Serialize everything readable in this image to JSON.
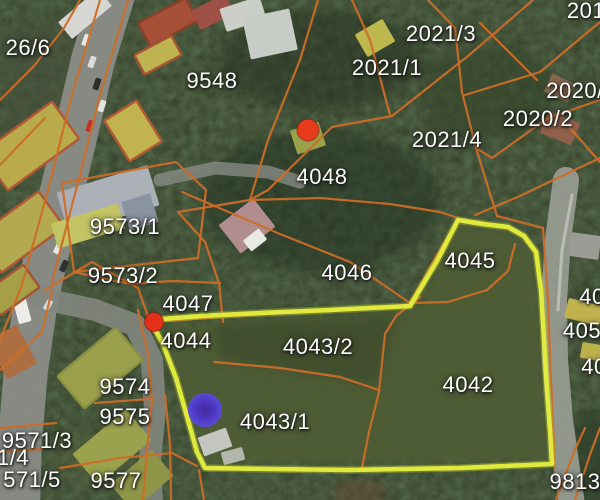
{
  "map": {
    "description": "cadastral parcel overlay on satellite imagery",
    "colors": {
      "forest_base": "#39462e",
      "foliage_dark": "#1a2914",
      "parcel_line": "#cc6d28",
      "highlight_outline": "#e6ef3e",
      "highlight_glow": "#b8c42c",
      "road_gray": "#8a8d87",
      "road_light": "#9b9e96",
      "label_text": "#fdfdfa",
      "marker_red": "#e6381d",
      "marker_purple_edge": "#5a49e0",
      "marker_purple_center": "#43279f"
    },
    "labels": [
      {
        "text": "26/6",
        "x": 28,
        "y": 48
      },
      {
        "text": "9548",
        "x": 212,
        "y": 81
      },
      {
        "text": "2021/3",
        "x": 441,
        "y": 34
      },
      {
        "text": "2021/1",
        "x": 387,
        "y": 68
      },
      {
        "text": "201",
        "x": 586,
        "y": 11
      },
      {
        "text": "2020/",
        "x": 575,
        "y": 91
      },
      {
        "text": "2020/2",
        "x": 538,
        "y": 119
      },
      {
        "text": "2021/4",
        "x": 447,
        "y": 140
      },
      {
        "text": "4048",
        "x": 322,
        "y": 177
      },
      {
        "text": "9573/1",
        "x": 125,
        "y": 227
      },
      {
        "text": "9573/2",
        "x": 123,
        "y": 276
      },
      {
        "text": "4047",
        "x": 188,
        "y": 304
      },
      {
        "text": "4044",
        "x": 186,
        "y": 341
      },
      {
        "text": "4046",
        "x": 347,
        "y": 273
      },
      {
        "text": "4045",
        "x": 470,
        "y": 261
      },
      {
        "text": "40",
        "x": 592,
        "y": 297
      },
      {
        "text": "405",
        "x": 582,
        "y": 331
      },
      {
        "text": "40",
        "x": 594,
        "y": 367
      },
      {
        "text": "4043/2",
        "x": 318,
        "y": 347
      },
      {
        "text": "4042",
        "x": 468,
        "y": 385
      },
      {
        "text": "4043/1",
        "x": 275,
        "y": 422
      },
      {
        "text": "9574",
        "x": 125,
        "y": 387
      },
      {
        "text": "9575",
        "x": 125,
        "y": 417
      },
      {
        "text": "9571/3",
        "x": 37,
        "y": 441
      },
      {
        "text": "1/4",
        "x": 13,
        "y": 458
      },
      {
        "text": "571/5",
        "x": 32,
        "y": 480
      },
      {
        "text": "9577",
        "x": 116,
        "y": 481
      },
      {
        "text": "9813",
        "x": 575,
        "y": 482
      }
    ],
    "markers": [
      {
        "name": "red-dot-marker",
        "kind": "red",
        "x": 308,
        "y": 130,
        "r": 11,
        "fill": "#e83a1d"
      },
      {
        "name": "red-pin-marker",
        "kind": "red",
        "x": 154,
        "y": 322,
        "r": 9.5,
        "fill": "#e5301c"
      },
      {
        "name": "purple-dot-marker",
        "kind": "purple",
        "x": 205,
        "y": 410,
        "r": 17
      }
    ],
    "highlight": {
      "name": "highlighted-parcel-outline",
      "points": "150,320 200,316 260,313 330,310 410,306 437,261 458,220 483,224 508,227 524,236 536,252 541,290 544,340 547,390 550,430 552,464 460,468 350,470 270,469 205,468 197,452 188,420 176,378 163,344"
    },
    "parcel_lines": [
      "100,0 72,95 48,190 22,285 0,340",
      "128,0 100,95 76,190 52,282",
      "0,100 34,66 64,28 80,0",
      "0,165 45,118",
      "318,0 300,60 268,140 250,200",
      "533,0 468,56 392,116 332,127 268,190 250,200",
      "428,0 455,28 462,92 476,148 492,200 497,216",
      "352,0 370,40 390,115",
      "600,22 540,72 465,95",
      "600,100 548,118 492,158 476,148",
      "480,23 537,80",
      "570,128 600,162",
      "475,215 520,196 562,176 600,158",
      "178,212 250,200 320,198 390,204 440,212 458,218",
      "182,192 280,234 350,262 410,303",
      "410,303 434,260 458,220",
      "62,183 176,162 206,190 198,258 74,272 62,183",
      "74,272 130,284 172,281 220,283",
      "219,283 223,322",
      "178,212 205,242 219,283",
      "150,322 220,317 300,312 412,306",
      "412,303 448,302 487,290 508,271 515,244",
      "420,297 396,316 385,334 379,392 369,432 362,468",
      "214,362 280,368 340,377 379,390",
      "543,228 548,300 551,380 555,468",
      "497,216 520,222 543,228",
      "575,500 591,452 600,428",
      "556,500 574,452 585,428",
      "45,290 92,262 138,288 150,322",
      "0,370 42,332 52,290",
      "138,310 148,355 152,400 147,450 143,500",
      "95,403 150,399",
      "60,468 120,458 172,453 197,466",
      "0,428 56,423",
      "0,452 42,449",
      "165,395 170,445 171,500",
      "199,470 204,500"
    ],
    "roads": [
      {
        "d": "M113,-5 L93,60 L72,150 L50,240 L36,300 L26,370 L20,440 L18,505",
        "width": 44,
        "color": "#8a8d87",
        "opacity": 0.95
      },
      {
        "d": "M40,298 L95,310 L135,325 L152,360 L155,410 L150,460 L152,505",
        "width": 22,
        "color": "#83867e",
        "opacity": 0.9
      },
      {
        "d": "M566,180 L558,240 L554,300 L555,360 L560,420 L572,505",
        "width": 26,
        "color": "#9b9e96",
        "opacity": 0.9
      },
      {
        "d": "M572,195 L562,250 L558,310",
        "width": 3,
        "color": "#e8eae4",
        "opacity": 0.45
      },
      {
        "d": "M160,180 L215,168 L268,172 L300,182",
        "width": 13,
        "color": "#888b84",
        "opacity": 0.8
      }
    ],
    "fields": [
      {
        "type": "polygon",
        "points": "415,310 455,225 505,228 535,252 542,330 548,430 550,462 210,464 195,430 178,380 160,325",
        "fill": "#4f5d35",
        "opacity": 0.9
      },
      {
        "type": "polygon",
        "points": "420,60 520,40 560,90 520,140 430,130",
        "fill": "#36452c",
        "opacity": 0.6
      },
      {
        "type": "polygon",
        "points": "0,30 80,10 120,60 60,140 0,150",
        "fill": "#46503a",
        "opacity": 0.55
      },
      {
        "type": "polygon",
        "points": "215,325 400,315 375,385 220,360",
        "fill": "#3c4a2c",
        "opacity": 0.7
      },
      {
        "type": "ellipse",
        "cx": 320,
        "cy": 200,
        "rx": 120,
        "ry": 70,
        "fill": "#243220",
        "opacity": 0.5
      },
      {
        "type": "ellipse",
        "cx": 320,
        "cy": 60,
        "rx": 100,
        "ry": 50,
        "fill": "#263322",
        "opacity": 0.5
      },
      {
        "type": "ellipse",
        "cx": 360,
        "cy": 492,
        "rx": 28,
        "ry": 11,
        "fill": "#6a4a34",
        "opacity": 0.55
      },
      {
        "type": "ellipse",
        "cx": 95,
        "cy": 460,
        "rx": 45,
        "ry": 30,
        "fill": "#55603c",
        "opacity": 0.4
      },
      {
        "type": "ellipse",
        "cx": 590,
        "cy": 460,
        "rx": 25,
        "ry": 50,
        "fill": "#2c3a26",
        "opacity": 0.6
      }
    ],
    "buildings": [
      {
        "x": 30,
        "y": 146,
        "w": 88,
        "h": 46,
        "r": -36,
        "fill": "#b9aa4b",
        "stroke": "#b15836"
      },
      {
        "x": 20,
        "y": 232,
        "w": 78,
        "h": 44,
        "r": -36,
        "fill": "#b3a94f",
        "stroke": "#b15836"
      },
      {
        "x": 12,
        "y": 290,
        "w": 48,
        "h": 28,
        "r": -36,
        "fill": "#a79f48",
        "stroke": "#a55534"
      },
      {
        "x": 85,
        "y": 14,
        "w": 52,
        "h": 22,
        "r": -40,
        "fill": "#d6d6d2"
      },
      {
        "x": 168,
        "y": 22,
        "w": 54,
        "h": 26,
        "r": -28,
        "fill": "#a65137",
        "stroke": "#8a4028"
      },
      {
        "x": 158,
        "y": 55,
        "w": 42,
        "h": 22,
        "r": -28,
        "fill": "#bfb251",
        "stroke": "#a55534"
      },
      {
        "x": 213,
        "y": 12,
        "w": 38,
        "h": 22,
        "r": -26,
        "fill": "#9e4f46"
      },
      {
        "x": 243,
        "y": 14,
        "w": 42,
        "h": 24,
        "r": -18,
        "fill": "#cccfc8"
      },
      {
        "x": 270,
        "y": 34,
        "w": 48,
        "h": 42,
        "r": -12,
        "fill": "#c8ccc6"
      },
      {
        "x": 133,
        "y": 131,
        "w": 38,
        "h": 48,
        "r": -32,
        "fill": "#c1b34e",
        "stroke": "#b15836"
      },
      {
        "x": 375,
        "y": 38,
        "w": 32,
        "h": 26,
        "r": -30,
        "fill": "#bfb84e"
      },
      {
        "x": 308,
        "y": 138,
        "w": 30,
        "h": 25,
        "r": -18,
        "fill": "#99a24a"
      },
      {
        "x": 247,
        "y": 226,
        "w": 44,
        "h": 36,
        "r": -38,
        "fill": "#b18e8d"
      },
      {
        "x": 255,
        "y": 240,
        "w": 20,
        "h": 14,
        "r": -38,
        "fill": "#e8e8e4"
      },
      {
        "x": 108,
        "y": 199,
        "w": 95,
        "h": 42,
        "r": -17,
        "fill": "#aab0b6"
      },
      {
        "x": 88,
        "y": 226,
        "w": 70,
        "h": 26,
        "r": -17,
        "fill": "#c3c565"
      },
      {
        "x": 140,
        "y": 212,
        "w": 30,
        "h": 30,
        "r": -17,
        "fill": "#8a93a0"
      },
      {
        "x": 560,
        "y": 128,
        "w": 34,
        "h": 24,
        "r": 22,
        "fill": "#92604a"
      },
      {
        "x": 560,
        "y": 88,
        "w": 26,
        "h": 20,
        "r": 25,
        "fill": "#8a6a50"
      },
      {
        "x": 585,
        "y": 246,
        "w": 30,
        "h": 24,
        "r": 8,
        "fill": "#9a9c95"
      },
      {
        "x": 584,
        "y": 312,
        "w": 36,
        "h": 20,
        "r": 14,
        "fill": "#c0b34d"
      },
      {
        "x": 594,
        "y": 352,
        "w": 26,
        "h": 16,
        "r": 10,
        "fill": "#bdb14c"
      },
      {
        "x": 100,
        "y": 368,
        "w": 76,
        "h": 42,
        "r": -40,
        "fill": "#9aa04b",
        "stroke": "#8a9040"
      },
      {
        "x": 112,
        "y": 447,
        "w": 70,
        "h": 40,
        "r": -40,
        "fill": "#9aa24d"
      },
      {
        "x": 142,
        "y": 480,
        "w": 54,
        "h": 34,
        "r": -40,
        "fill": "#8e9547"
      },
      {
        "x": 12,
        "y": 352,
        "w": 34,
        "h": 44,
        "r": -28,
        "fill": "#ad6f41"
      },
      {
        "x": 215,
        "y": 442,
        "w": 30,
        "h": 20,
        "r": -20,
        "fill": "#c6c6c0"
      },
      {
        "x": 233,
        "y": 456,
        "w": 22,
        "h": 13,
        "r": -15,
        "fill": "#b4b6ac"
      }
    ],
    "vehicles": [
      {
        "x": 86,
        "y": 40,
        "w": 12,
        "h": 6,
        "r": -70,
        "fill": "#e8e8e6"
      },
      {
        "x": 92,
        "y": 62,
        "w": 12,
        "h": 6,
        "r": -70,
        "fill": "#dcdcda"
      },
      {
        "x": 97,
        "y": 84,
        "w": 12,
        "h": 6,
        "r": -72,
        "fill": "#2e2e2e"
      },
      {
        "x": 102,
        "y": 106,
        "w": 12,
        "h": 6,
        "r": -72,
        "fill": "#e2e2e0"
      },
      {
        "x": 90,
        "y": 126,
        "w": 12,
        "h": 6,
        "r": -72,
        "fill": "#c23227"
      },
      {
        "x": 58,
        "y": 248,
        "w": 12,
        "h": 6,
        "r": -65,
        "fill": "#e6e6e4"
      },
      {
        "x": 64,
        "y": 266,
        "w": 12,
        "h": 6,
        "r": -65,
        "fill": "#303030"
      },
      {
        "x": 22,
        "y": 310,
        "w": 13,
        "h": 26,
        "r": -15,
        "fill": "#ececea"
      },
      {
        "x": 48,
        "y": 305,
        "w": 11,
        "h": 6,
        "r": -60,
        "fill": "#d8d8d6"
      }
    ]
  }
}
